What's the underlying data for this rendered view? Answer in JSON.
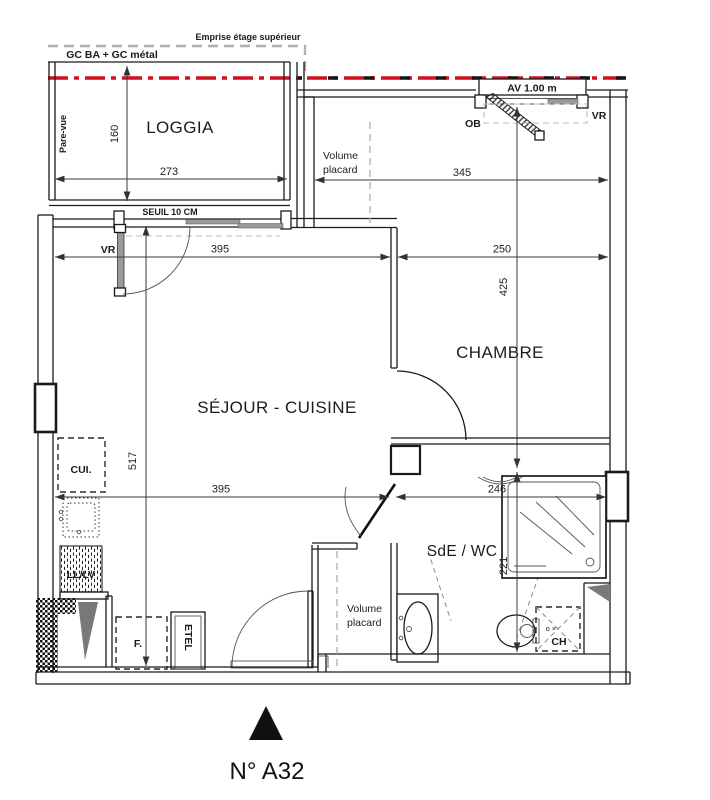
{
  "plan": {
    "unit_label": "N° A32",
    "rooms": {
      "loggia": "LOGGIA",
      "sejour": "SÉJOUR - CUISINE",
      "chambre": "CHAMBRE",
      "sde": "SdE / WC",
      "placard_word1": "Volume",
      "placard_word2": "placard"
    },
    "annotations": {
      "emprise": "Emprise étage supérieur",
      "gc": "GC BA + GC métal",
      "av_window": "AV 1.00 m",
      "ob": "OB",
      "vr_bedroom": "VR",
      "vr_living": "VR",
      "pare_vue": "Pare-vue",
      "seuil": "SEUIL 10 CM",
      "cui": "CUI.",
      "ll_lv": "LL/LV",
      "fridge": "F.",
      "etel": "ETEL",
      "ch": "CH",
      "ch_marks": "o ×"
    },
    "dimensions_cm": {
      "loggia_depth": "160",
      "loggia_width": "273",
      "chambre_zone_width": "345",
      "sejour_width": "395",
      "chambre_width": "250",
      "chambre_depth": "425",
      "sejour_depth": "517",
      "sejour_width_lower": "395",
      "sde_width": "246",
      "sde_depth": "221"
    },
    "colors": {
      "demolition_red": "#d00f1f",
      "emprise_gray": "#b0b0b0",
      "glazing_gray": "#9a9a9a",
      "wall_black": "#1a1a1a"
    }
  }
}
